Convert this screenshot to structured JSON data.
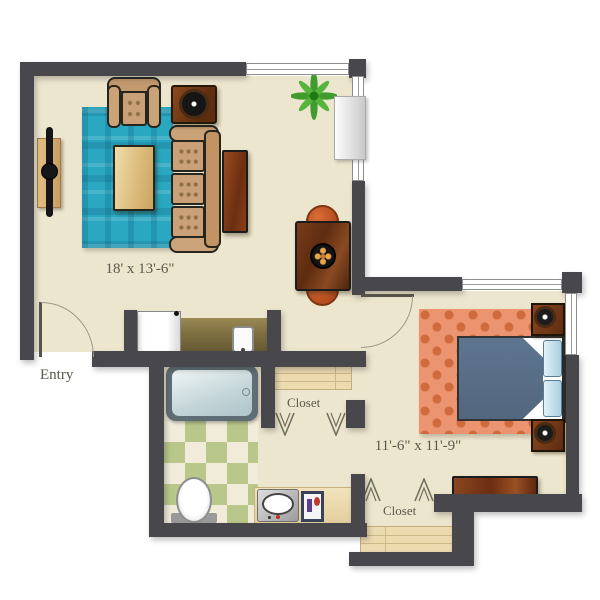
{
  "plan": {
    "type": "apartment-floor-plan",
    "labels": {
      "living_dimensions": "18' x 13'-6\"",
      "bedroom_dimensions": "11'-6\" x 11'-9\"",
      "entry": "Entry",
      "hall_closet": "Closet",
      "bedroom_closet": "Closet"
    },
    "rooms": [
      "Living Room",
      "Kitchenette",
      "Bathroom",
      "Hall Closet",
      "Bedroom",
      "Bedroom Closet",
      "Entry"
    ],
    "furniture": [
      "tv-console",
      "television",
      "teal-area-rug",
      "coffee-table",
      "sofa",
      "end-table",
      "armchair",
      "accent-table-with-bowl",
      "dining-table",
      "dining-chairs",
      "potted-plant",
      "console-cabinet",
      "refrigerator",
      "kitchen-counter",
      "kitchen-sink",
      "bathtub",
      "toilet",
      "vanity-sink",
      "toiletry-tray",
      "closet-shelves",
      "clothes-hangers",
      "bed",
      "pillows",
      "nightstands",
      "table-lamps",
      "dresser"
    ],
    "colors": {
      "wall": "#47474C",
      "floor": "#EDE6CE",
      "living_rug": "#2AA8C2",
      "bedroom_rug": "#EC9470",
      "bed_blanket": "#5E7590",
      "pillow_blue": "#BFDDEA",
      "tile_green": "#B9C78B",
      "wood_dark": "#7A3A1C",
      "upholstery_tan": "#C9A077",
      "chair_orange": "#C25022",
      "plant_green": "#3C9A28",
      "label_text": "#5B594C"
    }
  }
}
